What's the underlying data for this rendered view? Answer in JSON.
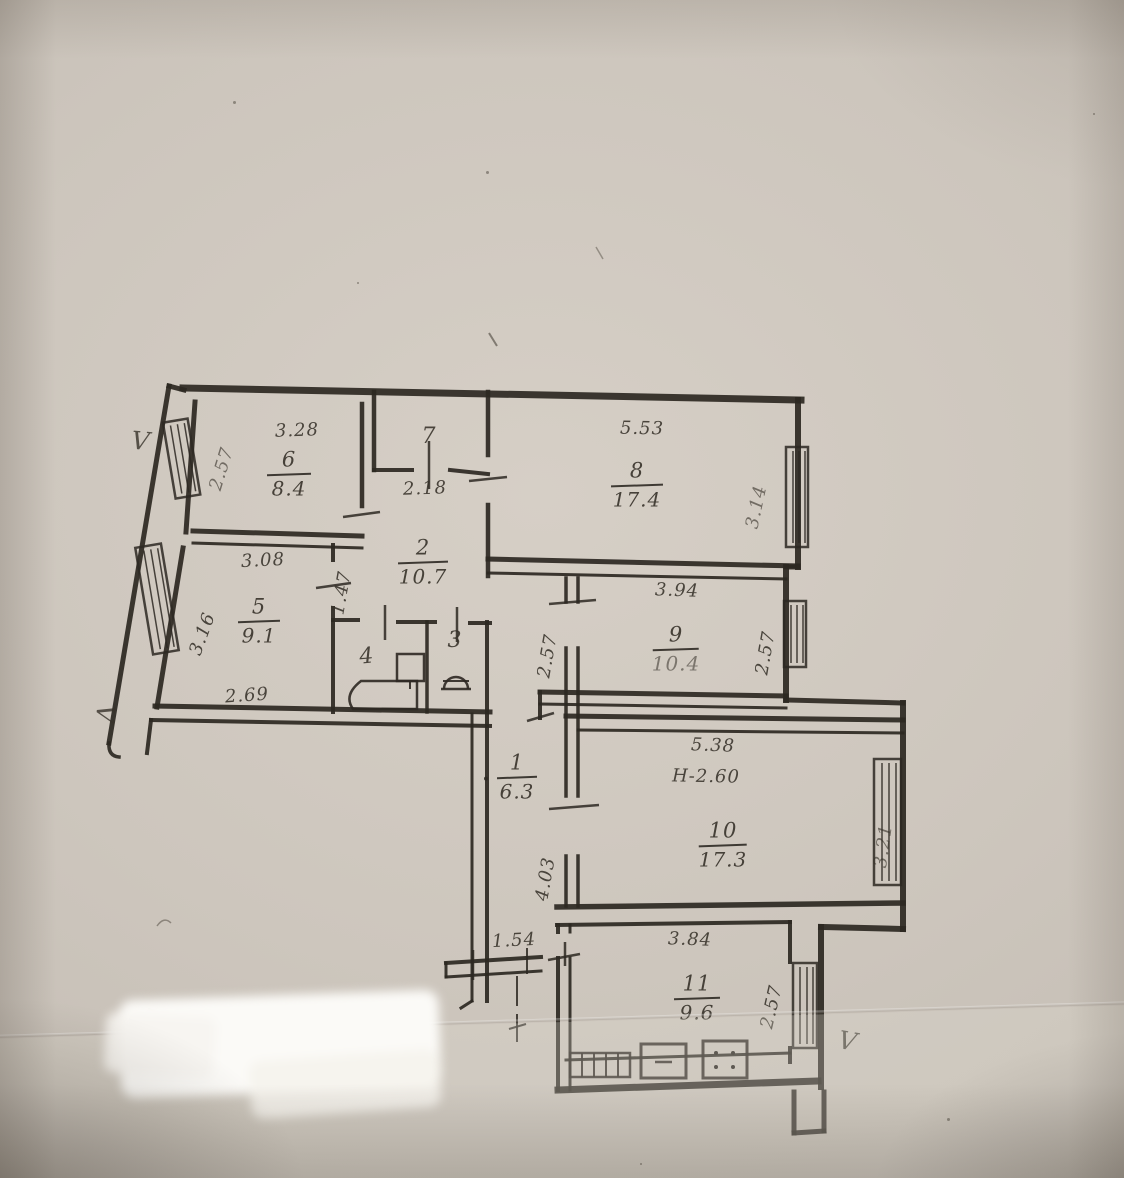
{
  "photo": {
    "paper_color": "#cdc6bd",
    "ink_color": "#2d2822",
    "description_note": "scanned BTI apartment floor plan"
  },
  "floor_plan": {
    "rooms": {
      "r1": {
        "number": "1",
        "area": "6.3"
      },
      "r2": {
        "number": "2",
        "area": "10.7"
      },
      "r3": {
        "number": "3"
      },
      "r4": {
        "number": "4"
      },
      "r5": {
        "number": "5",
        "area": "9.1"
      },
      "r6": {
        "number": "6",
        "area": "8.4"
      },
      "r7": {
        "number": "7"
      },
      "r8": {
        "number": "8",
        "area": "17.4"
      },
      "r9": {
        "number": "9",
        "area": "10.4"
      },
      "r10": {
        "number": "10",
        "area": "17.3",
        "ceiling_height": "H-2.60"
      },
      "r11": {
        "number": "11",
        "area": "9.6"
      }
    },
    "dimensions": {
      "r6_width": "3.28",
      "r6_left": "2.57",
      "r5_width": "3.08",
      "r5_left": "3.16",
      "r5_bottom": "2.69",
      "r7_below": "2.18",
      "r2_wall": "1.47",
      "r8_width": "5.53",
      "r8_right": "3.14",
      "r9_width": "3.94",
      "r9_left": "2.57",
      "r9_right": "2.57",
      "r1_vertical": "4.03",
      "r1_entry": "1.54",
      "r10_width": "5.38",
      "r10_right": "3.21",
      "r11_width": "3.84",
      "r11_right": "2.57"
    },
    "ventilation_marks": {
      "top_left": "V",
      "bottom_left": "V",
      "bottom_right": "V"
    }
  }
}
